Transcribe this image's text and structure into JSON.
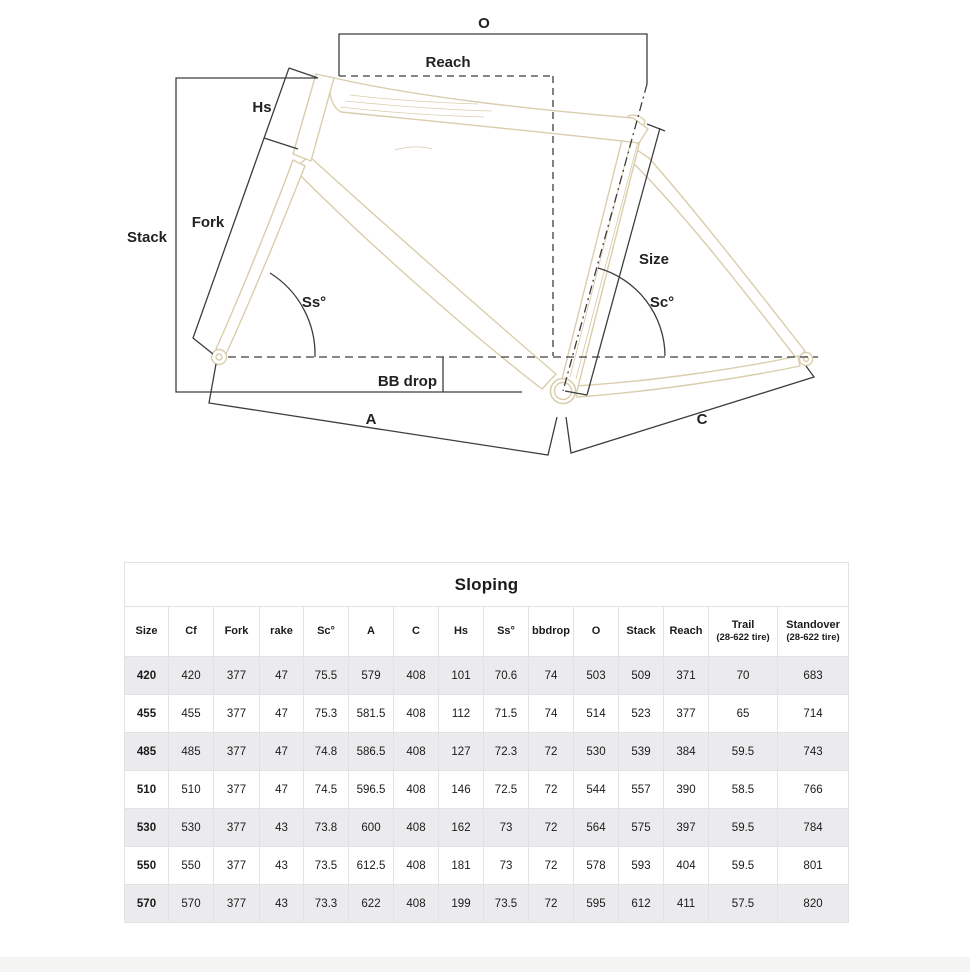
{
  "diagram": {
    "labels": {
      "o": "O",
      "reach": "Reach",
      "hs": "Hs",
      "fork": "Fork",
      "stack": "Stack",
      "size": "Size",
      "ss": "Ss°",
      "sc": "Sc°",
      "bb_drop": "BB drop",
      "a": "A",
      "c": "C"
    },
    "colors": {
      "frame": "#d9cdab",
      "dimension_lines": "#3d3d3d"
    }
  },
  "table": {
    "title": "Sloping",
    "columns": [
      {
        "label": "Size",
        "sub": ""
      },
      {
        "label": "Cf",
        "sub": ""
      },
      {
        "label": "Fork",
        "sub": ""
      },
      {
        "label": "rake",
        "sub": ""
      },
      {
        "label": "Sc°",
        "sub": ""
      },
      {
        "label": "A",
        "sub": ""
      },
      {
        "label": "C",
        "sub": ""
      },
      {
        "label": "Hs",
        "sub": ""
      },
      {
        "label": "Ss°",
        "sub": ""
      },
      {
        "label": "bbdrop",
        "sub": ""
      },
      {
        "label": "O",
        "sub": ""
      },
      {
        "label": "Stack",
        "sub": ""
      },
      {
        "label": "Reach",
        "sub": ""
      },
      {
        "label": "Trail",
        "sub": "(28-622 tire)"
      },
      {
        "label": "Standover",
        "sub": "(28-622 tire)"
      }
    ],
    "rows": [
      [
        "420",
        "420",
        "377",
        "47",
        "75.5",
        "579",
        "408",
        "101",
        "70.6",
        "74",
        "503",
        "509",
        "371",
        "70",
        "683"
      ],
      [
        "455",
        "455",
        "377",
        "47",
        "75.3",
        "581.5",
        "408",
        "112",
        "71.5",
        "74",
        "514",
        "523",
        "377",
        "65",
        "714"
      ],
      [
        "485",
        "485",
        "377",
        "47",
        "74.8",
        "586.5",
        "408",
        "127",
        "72.3",
        "72",
        "530",
        "539",
        "384",
        "59.5",
        "743"
      ],
      [
        "510",
        "510",
        "377",
        "47",
        "74.5",
        "596.5",
        "408",
        "146",
        "72.5",
        "72",
        "544",
        "557",
        "390",
        "58.5",
        "766"
      ],
      [
        "530",
        "530",
        "377",
        "43",
        "73.8",
        "600",
        "408",
        "162",
        "73",
        "72",
        "564",
        "575",
        "397",
        "59.5",
        "784"
      ],
      [
        "550",
        "550",
        "377",
        "43",
        "73.5",
        "612.5",
        "408",
        "181",
        "73",
        "72",
        "578",
        "593",
        "404",
        "59.5",
        "801"
      ],
      [
        "570",
        "570",
        "377",
        "43",
        "73.3",
        "622",
        "408",
        "199",
        "73.5",
        "72",
        "595",
        "612",
        "411",
        "57.5",
        "820"
      ]
    ]
  }
}
